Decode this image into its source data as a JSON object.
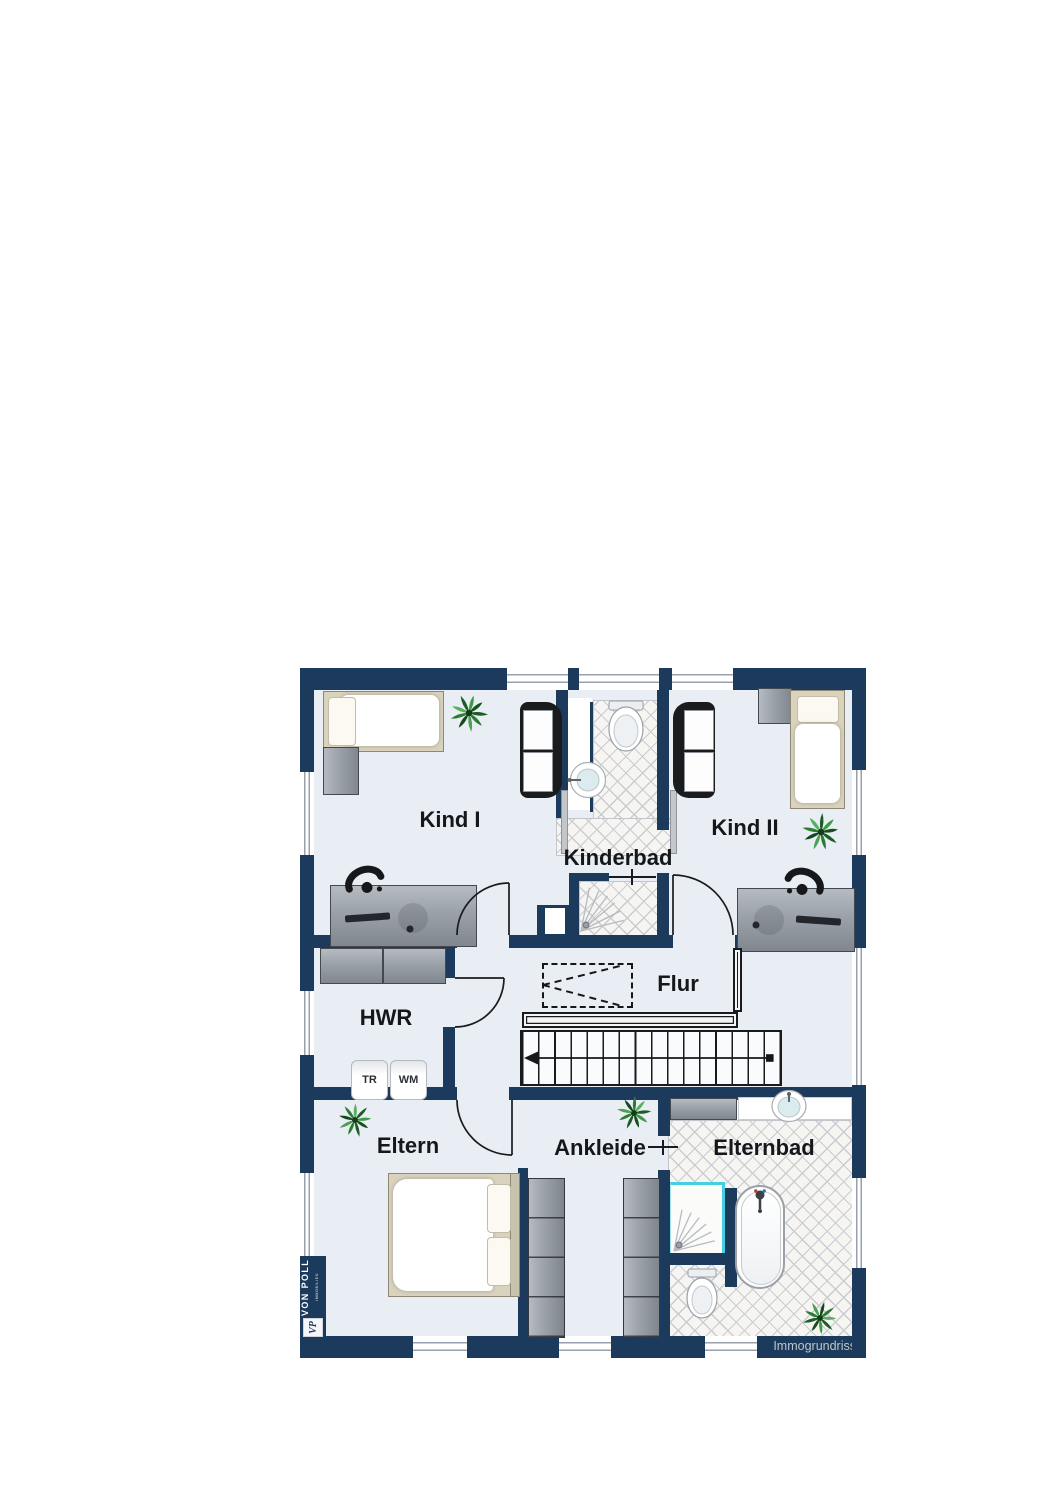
{
  "floorplan": {
    "rooms": {
      "kind1": "Kind I",
      "kind2": "Kind II",
      "kinderbad": "Kinderbad",
      "flur": "Flur",
      "hwr": "HWR",
      "eltern": "Eltern",
      "ankleide": "Ankleide",
      "elternbad": "Elternbad"
    },
    "appliances": {
      "dryer": "TR",
      "washer": "WM"
    },
    "watermark": "Immogrundriss",
    "logo": {
      "name": "VON POLL",
      "subtitle": "IMMOBILIEN",
      "monogram": "VP"
    },
    "colors": {
      "wall": "#1b3a5c",
      "floor": "#e9edf4",
      "tile_line": "#c9ccd1",
      "shower_glass": "#45cfe0",
      "furniture_gray": "#9aa1a9",
      "plant_green": "#2c7a33",
      "watermark_text": "#bcc6cf"
    }
  }
}
